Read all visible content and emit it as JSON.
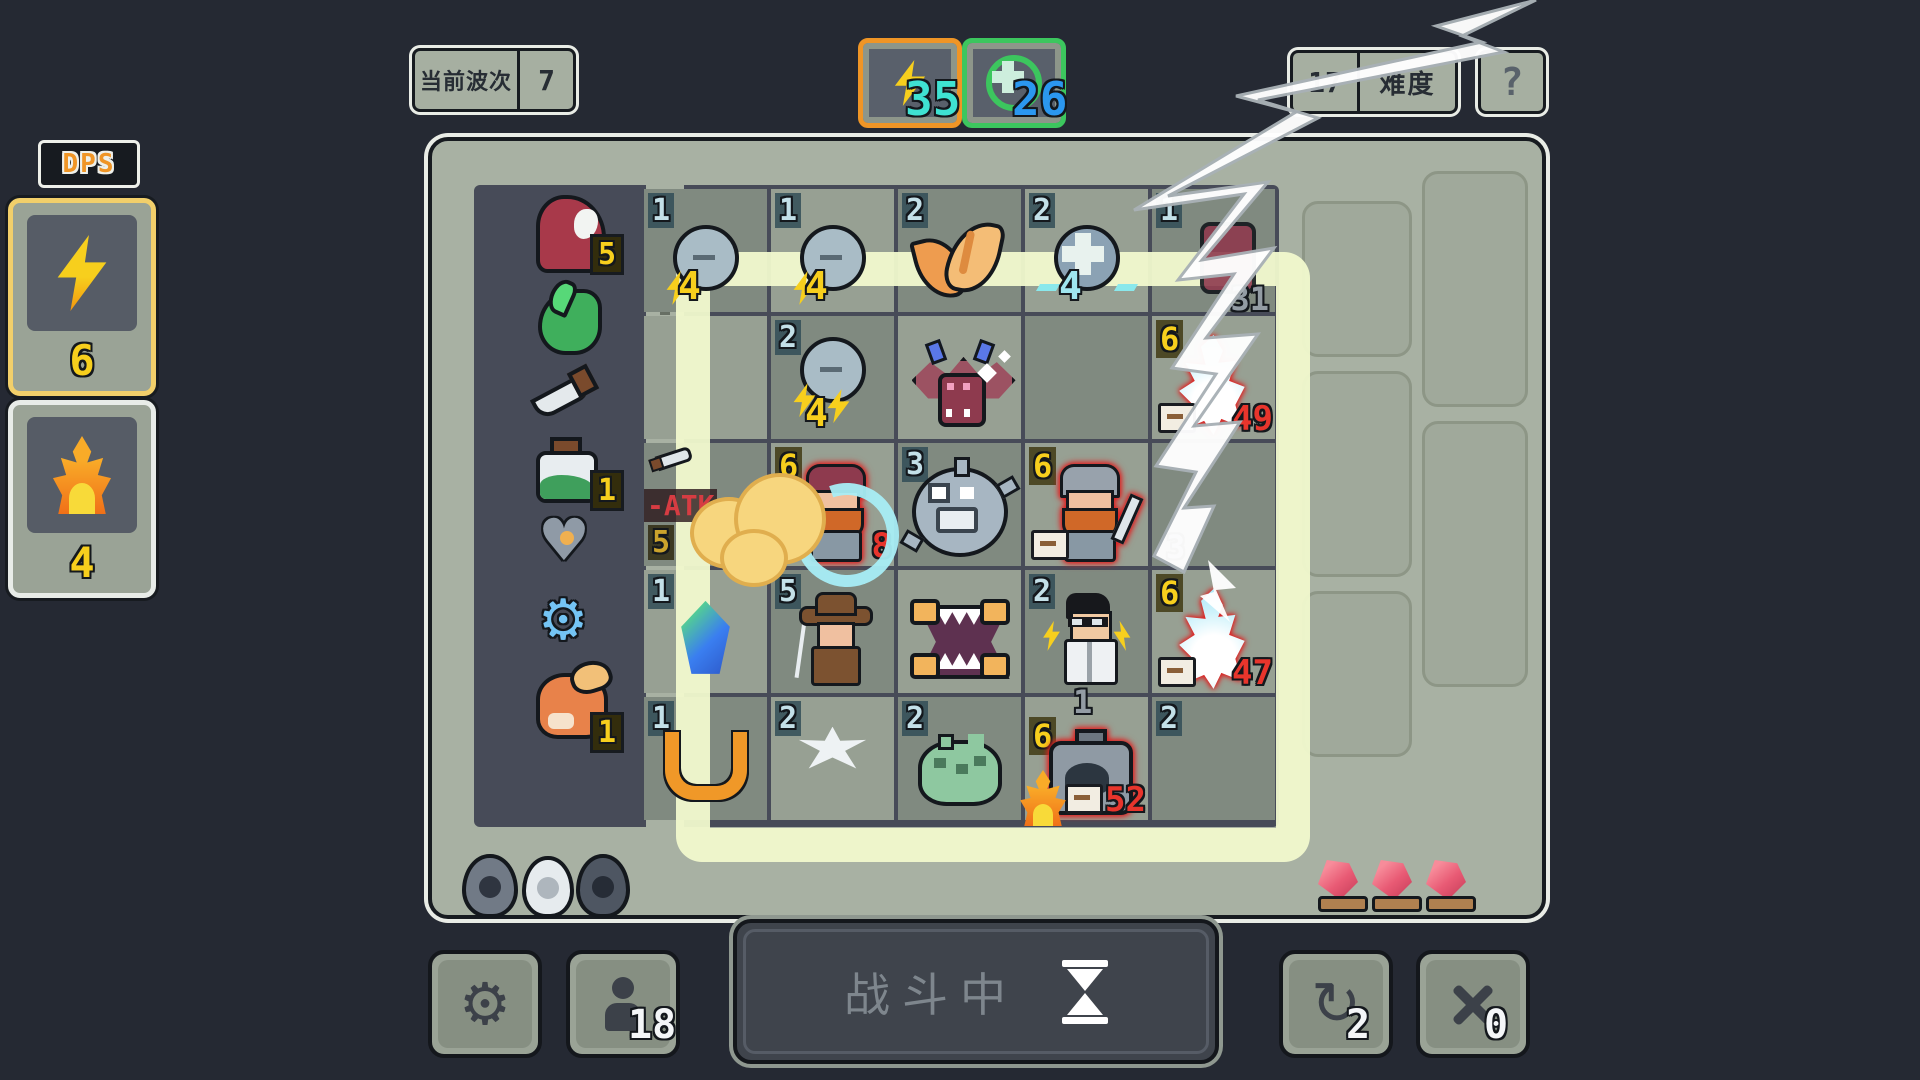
{
  "hud": {
    "wave_label": "当前波次",
    "wave_value": "7",
    "energy_value": "35",
    "heal_value": "26",
    "difficulty_value": "17",
    "difficulty_label": "难度",
    "help_label": "?"
  },
  "dps_panel": {
    "title": "DPS",
    "lightning_count": "6",
    "fire_count": "4",
    "accent_selected": "#f2cf6a"
  },
  "inventory": {
    "items": [
      {
        "name": "red-hood-minion",
        "count": "5"
      },
      {
        "name": "green-slime",
        "count": ""
      },
      {
        "name": "dagger",
        "count": ""
      },
      {
        "name": "green-potion",
        "count": "1"
      },
      {
        "name": "armored-heart",
        "count": ""
      },
      {
        "name": "blue-gear",
        "count": ""
      },
      {
        "name": "fox-pet",
        "count": "1"
      }
    ],
    "heart_glyph": "♥",
    "gear_glyph": "⚙"
  },
  "grid": {
    "r0": {
      "c0": {
        "count": "1",
        "char": "lightning-orb",
        "value": "4"
      },
      "c1": {
        "count": "1",
        "char": "lightning-orb",
        "value": "4"
      },
      "c2": {
        "count": "2",
        "char": "fox-creature"
      },
      "c3": {
        "count": "2",
        "char": "heal-orb",
        "value": "4"
      },
      "c4": {
        "count": "1",
        "char": "hero-struck-by-lightning",
        "block": "31"
      }
    },
    "r1": {
      "c1": {
        "count": "2",
        "char": "lightning-orb-double",
        "value": "4"
      },
      "c2": {
        "char": "bat-demon"
      },
      "c4": {
        "power": "6",
        "char": "burning-hero",
        "minus": "-",
        "damage": "49"
      }
    },
    "r2": {
      "c0": {
        "debuff": "-ATK",
        "count": "5",
        "char": "smoke-cloud"
      },
      "c1": {
        "power": "6",
        "char": "targeted-dwarf",
        "damage": "8"
      },
      "c2": {
        "count": "3",
        "char": "pufferfish"
      },
      "c3": {
        "power": "6",
        "char": "sword-dwarf",
        "minus": "-"
      },
      "c4": {
        "block": "3"
      }
    },
    "r3": {
      "c0": {
        "count": "1",
        "char": "crystal"
      },
      "c1": {
        "count": "5",
        "char": "explorer"
      },
      "c2": {
        "char": "mimic"
      },
      "c3": {
        "count": "2",
        "char": "scientist"
      },
      "c4": {
        "power": "6",
        "char": "burning-hero",
        "minus": "-",
        "damage": "47"
      }
    },
    "r4": {
      "c0": {
        "count": "1",
        "char": "horseshoe"
      },
      "c1": {
        "count": "2",
        "char": "white-spiky"
      },
      "c2": {
        "count": "2",
        "char": "green-frog"
      },
      "c3": {
        "block": "1",
        "power": "6",
        "char": "furnace",
        "minus": "-",
        "damage": "52"
      },
      "c4": {
        "count": "2"
      }
    }
  },
  "board": {
    "eggs": [
      "dark-egg",
      "white-egg",
      "black-egg"
    ],
    "gems": [
      "red-gem",
      "red-gem",
      "red-gem"
    ],
    "selection_color": "#f0f8cf"
  },
  "bottom_bar": {
    "battle_label": "战斗中",
    "hero_count": "18",
    "refresh_count": "2",
    "swap_count": "0",
    "gear_glyph": "⚙",
    "refresh_glyph": "↻"
  }
}
